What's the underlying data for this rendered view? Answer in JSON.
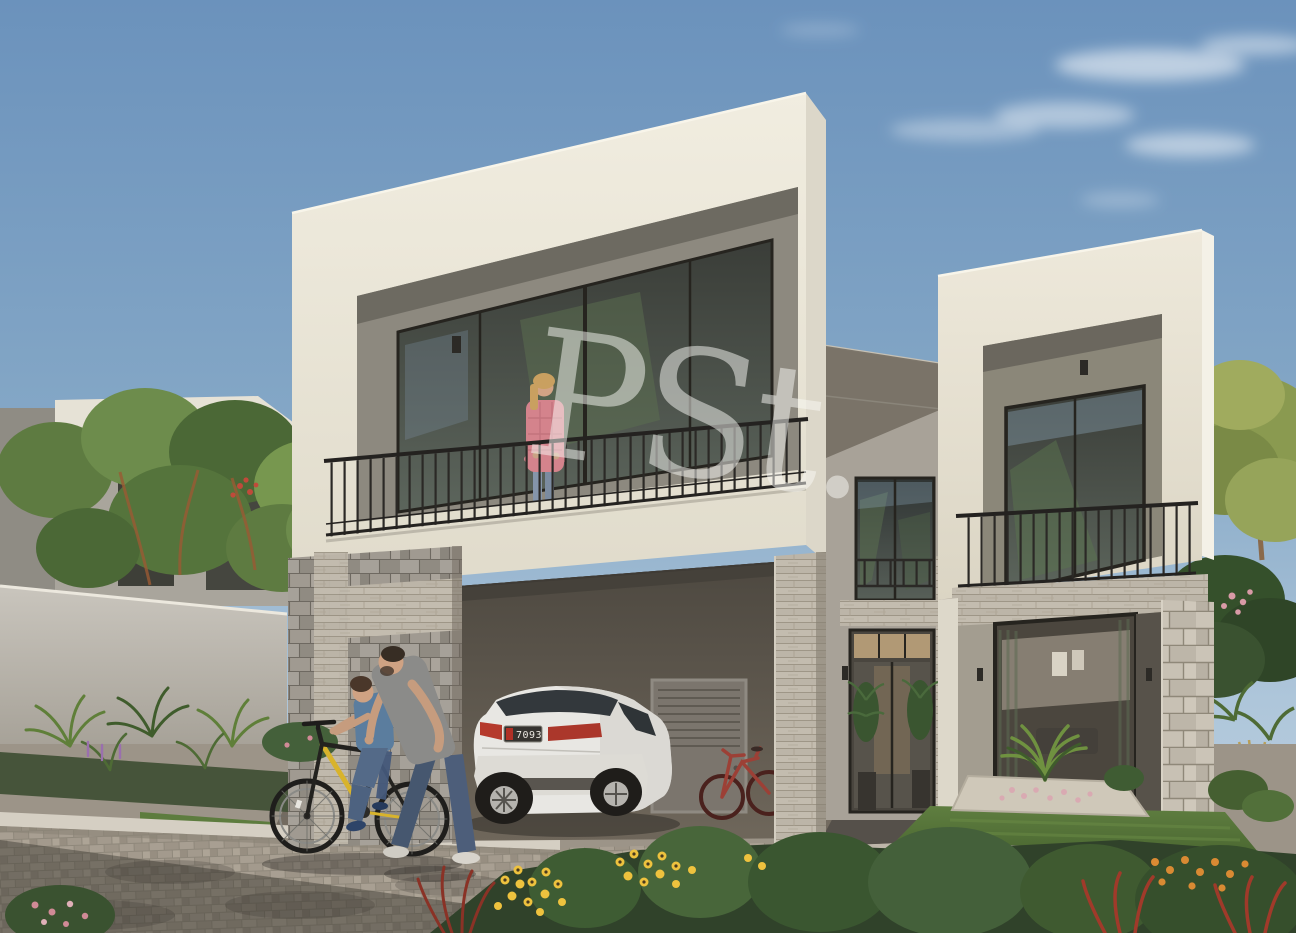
{
  "scene": {
    "watermark_text": "PSt.",
    "license_plate_text": "70934",
    "palette": {
      "sky_top": "#6b92bc",
      "sky_horizon": "#c2d4e2",
      "facade_cream": "#eae6d9",
      "recess_gray": "#8d897f",
      "stone_travertine": "#bcb5a8",
      "railing_black": "#2b2926",
      "paver_gray": "#a29a8c",
      "foliage_green": "#5e7b41",
      "flowers_yellow": "#eec23e",
      "flowers_orange": "#d98a33",
      "flowers_red": "#a03a2a",
      "car_body_white": "#e8e7e3",
      "plate_badge_red": "#b03026"
    }
  }
}
